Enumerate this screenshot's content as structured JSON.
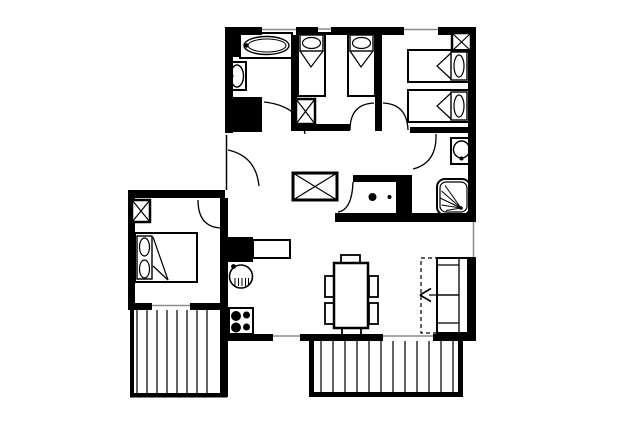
{
  "canvas": {
    "width": 640,
    "height": 427
  },
  "colors": {
    "ink": "#000000",
    "paper": "#ffffff",
    "window_line": "#8a8a8a",
    "stripe": "#222222"
  },
  "floorplan": {
    "kind": "apartment-floor-plan",
    "elements": [
      {
        "name": "wall-top",
        "kind": "rect",
        "x": 225,
        "y": 27,
        "w": 251,
        "h": 8,
        "fill": "ink"
      },
      {
        "name": "wall-left-upper",
        "kind": "rect",
        "x": 225,
        "y": 27,
        "w": 8,
        "h": 106,
        "fill": "ink"
      },
      {
        "name": "wall-right-upper",
        "kind": "rect",
        "x": 468,
        "y": 27,
        "w": 8,
        "h": 195,
        "fill": "ink"
      },
      {
        "name": "wall-bathroom-right",
        "kind": "rect",
        "x": 291,
        "y": 33,
        "w": 6,
        "h": 97,
        "fill": "ink"
      },
      {
        "name": "wall-bathroom-block",
        "kind": "rect",
        "x": 229,
        "y": 97,
        "w": 33,
        "h": 35,
        "fill": "ink"
      },
      {
        "name": "wall-bedroom-divider",
        "kind": "rect",
        "x": 375,
        "y": 27,
        "w": 7,
        "h": 104,
        "fill": "ink"
      },
      {
        "name": "wall-bedroom1-south",
        "kind": "rect",
        "x": 291,
        "y": 124,
        "w": 59,
        "h": 7,
        "fill": "ink"
      },
      {
        "name": "wall-bedroom2-south",
        "kind": "rect",
        "x": 410,
        "y": 127,
        "w": 66,
        "h": 6,
        "fill": "ink"
      },
      {
        "name": "wall-wc-north",
        "kind": "rect",
        "x": 353,
        "y": 175,
        "w": 44,
        "h": 7,
        "fill": "ink"
      },
      {
        "name": "wall-wc-block",
        "kind": "rect",
        "x": 396,
        "y": 175,
        "w": 16,
        "h": 38,
        "fill": "ink"
      },
      {
        "name": "wall-mid-south",
        "kind": "rect",
        "x": 335,
        "y": 213,
        "w": 141,
        "h": 9,
        "fill": "ink"
      },
      {
        "name": "wall-right-lower",
        "kind": "rect",
        "x": 467,
        "y": 257,
        "w": 9,
        "h": 84,
        "fill": "ink"
      },
      {
        "name": "wall-bottom",
        "kind": "rect",
        "x": 220,
        "y": 334,
        "w": 256,
        "h": 7,
        "fill": "ink"
      },
      {
        "name": "wall-leftroom-north",
        "kind": "rect",
        "x": 128,
        "y": 190,
        "w": 97,
        "h": 8,
        "fill": "ink"
      },
      {
        "name": "wall-leftroom-west",
        "kind": "rect",
        "x": 128,
        "y": 190,
        "w": 7,
        "h": 120,
        "fill": "ink"
      },
      {
        "name": "wall-leftroom-south",
        "kind": "rect",
        "x": 128,
        "y": 303,
        "w": 99,
        "h": 7,
        "fill": "ink"
      },
      {
        "name": "wall-kitchen-west",
        "kind": "rect",
        "x": 220,
        "y": 198,
        "w": 8,
        "h": 199,
        "fill": "ink"
      },
      {
        "name": "wall-kitchen-block",
        "kind": "rect",
        "x": 227,
        "y": 237,
        "w": 26,
        "h": 25,
        "fill": "ink"
      },
      {
        "name": "balcony-left-edge-west",
        "kind": "rect",
        "x": 130,
        "y": 310,
        "w": 4,
        "h": 87,
        "fill": "ink"
      },
      {
        "name": "balcony-left-edge-south",
        "kind": "rect",
        "x": 130,
        "y": 393,
        "w": 97,
        "h": 4.5,
        "fill": "ink"
      },
      {
        "name": "balcony-bottom-edge-west",
        "kind": "rect",
        "x": 309,
        "y": 341,
        "w": 5,
        "h": 56,
        "fill": "ink"
      },
      {
        "name": "balcony-bottom-edge-south",
        "kind": "rect",
        "x": 309,
        "y": 392,
        "w": 154,
        "h": 5,
        "fill": "ink"
      },
      {
        "name": "balcony-bottom-edge-east",
        "kind": "rect",
        "x": 458,
        "y": 341,
        "w": 5,
        "h": 56,
        "fill": "ink"
      },
      {
        "name": "balcony-left-stripes",
        "kind": "stripes",
        "xs": [
          137,
          147,
          157,
          167,
          177,
          187,
          197,
          207
        ],
        "y1": 310,
        "y2": 393,
        "stroke": "stripe",
        "sw": 1.4
      },
      {
        "name": "balcony-bottom-stripes",
        "kind": "stripes",
        "xs": [
          321,
          333,
          345,
          357,
          369,
          381,
          393,
          405,
          417,
          429,
          441,
          453
        ],
        "y1": 341,
        "y2": 392,
        "stroke": "stripe",
        "sw": 1.4
      },
      {
        "name": "window-top-bathroom",
        "kind": "window",
        "x": 262,
        "y": 27,
        "w": 34,
        "h": 8,
        "line": [
          262,
          29.5,
          296,
          29.5
        ]
      },
      {
        "name": "window-top-vent",
        "kind": "window",
        "x": 318,
        "y": 27,
        "w": 13,
        "h": 5,
        "line": [
          318,
          29,
          331,
          29
        ]
      },
      {
        "name": "window-top-bedroom2",
        "kind": "window",
        "x": 404,
        "y": 27,
        "w": 34,
        "h": 8,
        "line": [
          404,
          29.5,
          438,
          29.5
        ]
      },
      {
        "name": "window-right-living",
        "kind": "window",
        "x": 468,
        "y": 222,
        "w": 8,
        "h": 35,
        "line": [
          473.5,
          222,
          473.5,
          257
        ]
      },
      {
        "name": "window-bottom-kitchen",
        "kind": "window",
        "x": 273,
        "y": 334,
        "w": 27,
        "h": 7,
        "line": [
          273,
          336,
          300,
          336
        ]
      },
      {
        "name": "window-bottom-living",
        "kind": "window",
        "x": 383,
        "y": 334,
        "w": 50,
        "h": 7,
        "line": [
          383,
          336,
          433,
          336
        ]
      },
      {
        "name": "window-leftroom-south",
        "kind": "window",
        "x": 152,
        "y": 303,
        "w": 38,
        "h": 7,
        "line": [
          152,
          305.5,
          190,
          305.5
        ]
      },
      {
        "name": "entrance-opening",
        "kind": "window",
        "x": 225,
        "y": 133,
        "w": 8,
        "h": 59,
        "line": [
          226.5,
          135,
          226.5,
          190
        ],
        "lc": "ink"
      },
      {
        "name": "door-arc-entrance",
        "kind": "path",
        "d": "M228,150 Q256,156 259,186",
        "sw": 1.3
      },
      {
        "name": "door-arc-bathroom",
        "kind": "path",
        "d": "M264,102 Q300,106 305,134",
        "sw": 1.3
      },
      {
        "name": "door-arc-left-bedroom",
        "kind": "path",
        "d": "M198,200 Q198,227 221,228",
        "sw": 1.3
      },
      {
        "name": "door-arc-bedroom1",
        "kind": "path",
        "d": "M350,130 Q350,104 374,103",
        "sw": 1.3
      },
      {
        "name": "door-arc-bedroom2",
        "kind": "path",
        "d": "M383,103 Q407,104 408,130",
        "sw": 1.3
      },
      {
        "name": "door-arc-shower-room",
        "kind": "path",
        "d": "M436,134 Q437,163 413,169",
        "sw": 1.3
      },
      {
        "name": "door-arc-wc",
        "kind": "path",
        "d": "M353,182 Q352,210 338,212",
        "sw": 1.3
      },
      {
        "name": "bathtub-black-box",
        "kind": "rect",
        "x": 229,
        "y": 33,
        "w": 11,
        "h": 24,
        "fill": "ink"
      },
      {
        "name": "bathtub-surround",
        "kind": "rect",
        "x": 240,
        "y": 33,
        "w": 52,
        "h": 25,
        "sw": 2
      },
      {
        "name": "bathtub-outer",
        "kind": "ellipse",
        "cx": 266.5,
        "cy": 45.5,
        "rx": 22.5,
        "ry": 9,
        "sw": 1.4
      },
      {
        "name": "bathtub-inner",
        "kind": "ellipse",
        "cx": 267,
        "cy": 45.5,
        "rx": 19,
        "ry": 6.5,
        "sw": 1
      },
      {
        "name": "bathtub-faucet",
        "kind": "circle",
        "cx": 246.5,
        "cy": 45.5,
        "r": 2.2,
        "fill": "ink"
      },
      {
        "name": "washbasin-bath-frame",
        "kind": "rect",
        "x": 228,
        "y": 62,
        "w": 18,
        "h": 28,
        "sw": 2
      },
      {
        "name": "washbasin-bath-bowl",
        "kind": "ellipse",
        "cx": 237,
        "cy": 76,
        "rx": 6.5,
        "ry": 11,
        "sw": 1.4
      },
      {
        "name": "washbasin-bath-tap",
        "kind": "circle",
        "cx": 231.5,
        "cy": 76,
        "r": 2,
        "fill": "ink"
      },
      {
        "name": "wardrobe-xbox-bedroom1",
        "kind": "xbox",
        "x": 296,
        "y": 99,
        "w": 19,
        "h": 25,
        "sw": 2.5
      },
      {
        "name": "bed1-frame",
        "kind": "rect",
        "x": 298,
        "y": 33,
        "w": 27,
        "h": 63,
        "sw": 2
      },
      {
        "name": "bed1-pillow",
        "kind": "rect",
        "x": 300,
        "y": 35,
        "w": 23,
        "h": 16,
        "sw": 1.4
      },
      {
        "name": "bed1-pillow-oval",
        "kind": "ellipse",
        "cx": 311.5,
        "cy": 43,
        "rx": 9,
        "ry": 5.5,
        "sw": 1.2
      },
      {
        "name": "bed1-fold",
        "kind": "polyline",
        "points": "300,51 311,67 323,51",
        "sw": 1.2
      },
      {
        "name": "bed2-frame",
        "kind": "rect",
        "x": 348,
        "y": 33,
        "w": 27,
        "h": 63,
        "sw": 2
      },
      {
        "name": "bed2-pillow",
        "kind": "rect",
        "x": 350,
        "y": 35,
        "w": 23,
        "h": 16,
        "sw": 1.4
      },
      {
        "name": "bed2-pillow-oval",
        "kind": "ellipse",
        "cx": 361.5,
        "cy": 43,
        "rx": 9,
        "ry": 5.5,
        "sw": 1.2
      },
      {
        "name": "bed2-fold",
        "kind": "polyline",
        "points": "350,51 361,67 373,51",
        "sw": 1.2
      },
      {
        "name": "wardrobe-xbox-bedroom2",
        "kind": "xbox",
        "x": 452,
        "y": 33,
        "w": 19,
        "h": 18,
        "sw": 2.5
      },
      {
        "name": "bed3-frame",
        "kind": "rect",
        "x": 408,
        "y": 50,
        "w": 61,
        "h": 32,
        "sw": 2
      },
      {
        "name": "bed3-pillow",
        "kind": "rect",
        "x": 451,
        "y": 52,
        "w": 16,
        "h": 28,
        "sw": 1.4
      },
      {
        "name": "bed3-pillow-oval",
        "kind": "ellipse",
        "cx": 459,
        "cy": 66,
        "rx": 5,
        "ry": 11,
        "sw": 1.2
      },
      {
        "name": "bed3-fold",
        "kind": "polyline",
        "points": "451,53 437,66 451,79",
        "sw": 1.2
      },
      {
        "name": "bed4-frame",
        "kind": "rect",
        "x": 408,
        "y": 90,
        "w": 61,
        "h": 32,
        "sw": 2
      },
      {
        "name": "bed4-pillow",
        "kind": "rect",
        "x": 451,
        "y": 92,
        "w": 16,
        "h": 28,
        "sw": 1.4
      },
      {
        "name": "bed4-pillow-oval",
        "kind": "ellipse",
        "cx": 459,
        "cy": 106,
        "rx": 5,
        "ry": 11,
        "sw": 1.2
      },
      {
        "name": "bed4-fold",
        "kind": "polyline",
        "points": "451,93 437,106 451,119",
        "sw": 1.2
      },
      {
        "name": "washbasin-shower-frame",
        "kind": "rect",
        "x": 451,
        "y": 138,
        "w": 21,
        "h": 26,
        "sw": 2
      },
      {
        "name": "washbasin-shower-bowl",
        "kind": "ellipse",
        "cx": 461.5,
        "cy": 149.5,
        "rx": 8,
        "ry": 8.5,
        "sw": 1.4
      },
      {
        "name": "washbasin-shower-tap",
        "kind": "circle",
        "cx": 461.5,
        "cy": 158.5,
        "r": 2,
        "fill": "ink"
      },
      {
        "name": "shower-tray-outer",
        "kind": "rect",
        "x": 437,
        "y": 179,
        "w": 33,
        "h": 36,
        "rx": 8,
        "sw": 2
      },
      {
        "name": "shower-tray-inner",
        "kind": "rect",
        "x": 440,
        "y": 182,
        "w": 27,
        "h": 30,
        "rx": 6,
        "sw": 1.2
      },
      {
        "name": "shower-fan-1",
        "kind": "line",
        "x1": 461,
        "y1": 208,
        "x2": 445,
        "y2": 185.5,
        "sw": 1
      },
      {
        "name": "shower-fan-2",
        "kind": "line",
        "x1": 461,
        "y1": 208,
        "x2": 441.5,
        "y2": 191,
        "sw": 1
      },
      {
        "name": "shower-fan-3",
        "kind": "line",
        "x1": 461,
        "y1": 208,
        "x2": 440,
        "y2": 198,
        "sw": 1
      },
      {
        "name": "shower-fan-4",
        "kind": "line",
        "x1": 461,
        "y1": 208,
        "x2": 441.5,
        "y2": 205,
        "sw": 1
      },
      {
        "name": "shower-fan-5",
        "kind": "line",
        "x1": 461,
        "y1": 208,
        "x2": 446,
        "y2": 210.5,
        "sw": 1
      },
      {
        "name": "shower-drain",
        "kind": "circle",
        "cx": 461,
        "cy": 208,
        "r": 1.8,
        "fill": "ink"
      },
      {
        "name": "toilet-bowl",
        "kind": "ellipse",
        "cx": 374,
        "cy": 197,
        "rx": 10,
        "ry": 8,
        "fill": "paper",
        "sw": 1.5
      },
      {
        "name": "toilet-bowl-dot",
        "kind": "circle",
        "cx": 372.5,
        "cy": 197,
        "r": 4,
        "fill": "ink"
      },
      {
        "name": "toilet-tank",
        "kind": "ellipse",
        "cx": 389.5,
        "cy": 197,
        "rx": 6.5,
        "ry": 13.5,
        "fill": "paper",
        "sw": 1.5
      },
      {
        "name": "toilet-tank-dot",
        "kind": "circle",
        "cx": 389.5,
        "cy": 197,
        "r": 2,
        "fill": "ink"
      },
      {
        "name": "wardrobe-xbox-hall",
        "kind": "xbox",
        "x": 293,
        "y": 173,
        "w": 44,
        "h": 27,
        "sw": 3
      },
      {
        "name": "wardrobe-xbox-leftroom",
        "kind": "xbox",
        "x": 132,
        "y": 200,
        "w": 18,
        "h": 22,
        "sw": 2.5
      },
      {
        "name": "double-bed-frame",
        "kind": "rect",
        "x": 135,
        "y": 233,
        "w": 62,
        "h": 49,
        "sw": 2
      },
      {
        "name": "double-bed-pillows",
        "kind": "rect",
        "x": 137,
        "y": 236,
        "w": 15,
        "h": 43,
        "sw": 1.4
      },
      {
        "name": "double-bed-pillow-oval-1",
        "kind": "ellipse",
        "cx": 144.5,
        "cy": 247,
        "rx": 5,
        "ry": 9,
        "sw": 1.2
      },
      {
        "name": "double-bed-pillow-oval-2",
        "kind": "ellipse",
        "cx": 144.5,
        "cy": 269,
        "rx": 5,
        "ry": 9,
        "sw": 1.2
      },
      {
        "name": "double-bed-fold",
        "kind": "polyline",
        "points": "153,237 168,280 153,266",
        "sw": 1.2
      },
      {
        "name": "kitchen-counter",
        "kind": "rect",
        "x": 253,
        "y": 240,
        "w": 37,
        "h": 18,
        "sw": 2
      },
      {
        "name": "kitchen-sink",
        "kind": "circle",
        "cx": 241,
        "cy": 276.5,
        "r": 11.5,
        "sw": 1.6
      },
      {
        "name": "kitchen-sink-tap",
        "kind": "circle",
        "cx": 233.5,
        "cy": 266.5,
        "r": 2.4,
        "fill": "ink"
      },
      {
        "name": "kitchen-sink-hatch",
        "kind": "stripes",
        "xs": [
          235,
          238.5,
          242,
          245.5,
          248.5
        ],
        "y1": 278,
        "y2": 286,
        "stroke": "ink",
        "sw": 1
      },
      {
        "name": "stove-frame",
        "kind": "rect",
        "x": 229,
        "y": 308,
        "w": 24,
        "h": 26,
        "sw": 2
      },
      {
        "name": "stove-burner-1",
        "kind": "circle",
        "cx": 236,
        "cy": 316,
        "r": 5,
        "fill": "ink"
      },
      {
        "name": "stove-burner-2",
        "kind": "circle",
        "cx": 246.5,
        "cy": 315,
        "r": 3.5,
        "fill": "ink"
      },
      {
        "name": "stove-burner-3",
        "kind": "circle",
        "cx": 236,
        "cy": 327.5,
        "r": 5,
        "fill": "ink"
      },
      {
        "name": "stove-burner-4",
        "kind": "circle",
        "cx": 246.5,
        "cy": 327,
        "r": 3.5,
        "fill": "ink"
      },
      {
        "name": "dining-table",
        "kind": "rect",
        "x": 334,
        "y": 263,
        "w": 34,
        "h": 65,
        "sw": 2.5
      },
      {
        "name": "chair-top",
        "kind": "rect",
        "x": 341,
        "y": 255,
        "w": 19,
        "h": 8,
        "sw": 1.8
      },
      {
        "name": "chair-bottom",
        "kind": "rect",
        "x": 342,
        "y": 328,
        "w": 19,
        "h": 8,
        "sw": 1.8
      },
      {
        "name": "chair-left-1",
        "kind": "rect",
        "x": 325,
        "y": 276,
        "w": 9,
        "h": 21,
        "sw": 1.8
      },
      {
        "name": "chair-left-2",
        "kind": "rect",
        "x": 325,
        "y": 303,
        "w": 9,
        "h": 21,
        "sw": 1.8
      },
      {
        "name": "chair-right-1",
        "kind": "rect",
        "x": 369,
        "y": 276,
        "w": 9,
        "h": 21,
        "sw": 1.8
      },
      {
        "name": "chair-right-2",
        "kind": "rect",
        "x": 369,
        "y": 303,
        "w": 9,
        "h": 21,
        "sw": 1.8
      },
      {
        "name": "sofa-bed-frame",
        "kind": "rect",
        "x": 437,
        "y": 258,
        "w": 31,
        "h": 75,
        "sw": 2
      },
      {
        "name": "sofa-backrest-line",
        "kind": "line",
        "x1": 459,
        "y1": 258,
        "x2": 459,
        "y2": 333,
        "sw": 1.3
      },
      {
        "name": "sofa-armrest-top",
        "kind": "line",
        "x1": 437,
        "y1": 265,
        "x2": 459,
        "y2": 265,
        "sw": 1.3
      },
      {
        "name": "sofa-cushion-divider",
        "kind": "line",
        "x1": 437,
        "y1": 295,
        "x2": 459,
        "y2": 295,
        "sw": 1.3
      },
      {
        "name": "sofa-armrest-bottom",
        "kind": "line",
        "x1": 437,
        "y1": 323,
        "x2": 459,
        "y2": 323,
        "sw": 1.3
      },
      {
        "name": "sofa-pullout-dashed",
        "kind": "rect",
        "x": 421,
        "y": 258,
        "w": 16,
        "h": 75,
        "sw": 1.2,
        "dash": "4,3"
      },
      {
        "name": "sofa-pullout-arrow-shaft",
        "kind": "line",
        "x1": 429,
        "y1": 295,
        "x2": 458,
        "y2": 295,
        "sw": 1.3
      },
      {
        "name": "sofa-pullout-arrow-head-1",
        "kind": "line",
        "x1": 420,
        "y1": 295,
        "x2": 431,
        "y2": 288.5,
        "sw": 1.6
      },
      {
        "name": "sofa-pullout-arrow-head-2",
        "kind": "line",
        "x1": 420,
        "y1": 295,
        "x2": 431,
        "y2": 301.5,
        "sw": 1.6
      }
    ]
  }
}
